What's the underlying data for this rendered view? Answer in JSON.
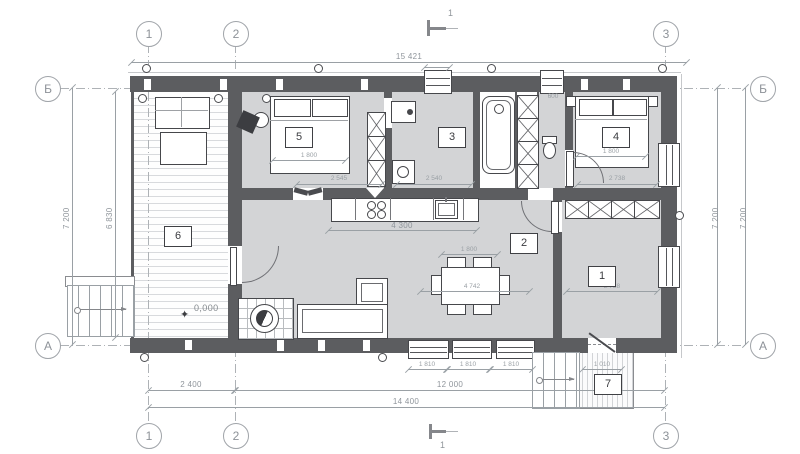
{
  "meta": {
    "drawing_type": "architectural floor plan, first floor"
  },
  "colors": {
    "wall": "#5c5d60",
    "floor": "#d3d4d6",
    "line": "#46474b",
    "dimension": "#9aa0a5"
  },
  "axes": {
    "vertical": [
      {
        "label": "1"
      },
      {
        "label": "2"
      },
      {
        "label": "3"
      }
    ],
    "horizontal": [
      {
        "label": "Б"
      },
      {
        "label": "А"
      }
    ]
  },
  "rooms": [
    {
      "number": "1"
    },
    {
      "number": "2"
    },
    {
      "number": "3"
    },
    {
      "number": "4"
    },
    {
      "number": "5"
    },
    {
      "number": "6"
    },
    {
      "number": "7"
    }
  ],
  "dimensions": {
    "overall_top": "15 421",
    "side_left_outer": "7 200",
    "side_left_inner": "6 830",
    "side_right_inner": "7 200",
    "side_right_outer": "7 200",
    "bottom_grid_1_2": "2 400",
    "bottom_grid_2_3": "12 000",
    "bottom_overall": "14 400",
    "kitchen_run": "4 300",
    "bed_room5": "1 800",
    "bed_room4": "1 800",
    "dining_table": "1 800",
    "living_room_width": "4 742",
    "room3_width": "2 540",
    "room5_width": "2 545",
    "room4_width": "2 738",
    "room1_width": "2 738",
    "corridor_width": "600",
    "porch_width": "1 010",
    "window_bottom_1": "1 810",
    "window_bottom_2": "1 810",
    "window_bottom_3": "1 810"
  },
  "marks": {
    "level": "0,000",
    "section_top": "1",
    "section_bottom": "1"
  }
}
